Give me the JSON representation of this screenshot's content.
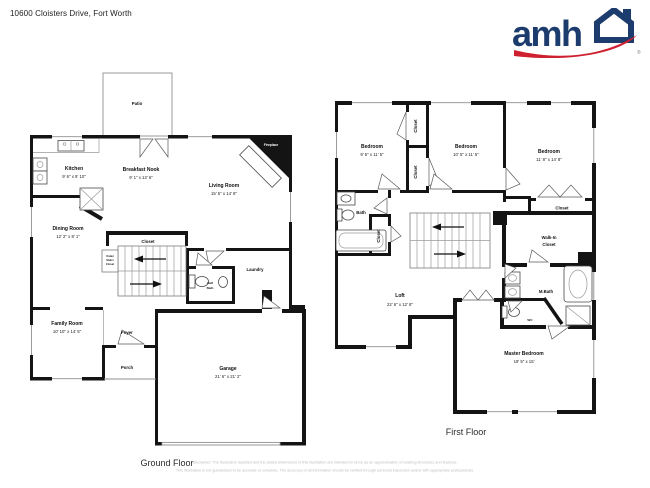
{
  "header": {
    "address": "10600 Cloisters Drive, Fort Worth"
  },
  "logo": {
    "brand": "amh",
    "registered": "®",
    "navy": "#1d3c6e",
    "red": "#cf2030"
  },
  "ground_floor": {
    "title": "Ground Floor",
    "patio": {
      "name": "Patio"
    },
    "kitchen": {
      "name": "Kitchen",
      "dims": "9' 6\" x 9' 10\""
    },
    "breakfast_nook": {
      "name": "Breakfast Nook",
      "dims": "9' 1\" x 12' 6\""
    },
    "living_room": {
      "name": "Living Room",
      "dims": "15' 5\" x 14' 8\""
    },
    "dining_room": {
      "name": "Dining Room",
      "dims": "12' 2\" x 8' 1\""
    },
    "family_room": {
      "name": "Family Room",
      "dims": "10' 10\" x 14' 5\""
    },
    "garage": {
      "name": "Garage",
      "dims": "21' 6\" x 21' 2\""
    },
    "foyer": {
      "name": "Foyer"
    },
    "porch": {
      "name": "Porch"
    },
    "laundry": {
      "name": "Laundry"
    },
    "stairs_closet": {
      "name": "Closet"
    },
    "under_stairs_closet": {
      "line1": "Under",
      "line2": "Stairs",
      "line3": "Closet"
    },
    "half_bath": {
      "line1": "Half",
      "line2": "Bath"
    },
    "fireplace": {
      "name": "Fireplace"
    }
  },
  "first_floor": {
    "title": "First Floor",
    "bedroom_1": {
      "name": "Bedroom",
      "dims": "9' 5\" x 11' 5\""
    },
    "bedroom_2": {
      "name": "Bedroom",
      "dims": "10' 5\" x 11' 5\""
    },
    "bedroom_3": {
      "name": "Bedroom",
      "dims": "11' 8\" x 14' 8\""
    },
    "closet_1": {
      "name": "Closet"
    },
    "closet_2": {
      "name": "Closet"
    },
    "bedroom_3_closet": {
      "name": "Closet"
    },
    "bath": {
      "name": "Bath"
    },
    "bath_closet": {
      "name": "Closet"
    },
    "walk_in_closet": {
      "line1": "Walk-In",
      "line2": "Closet"
    },
    "loft": {
      "name": "Loft",
      "dims": "22' 6\" x 12' 8\""
    },
    "master_bath": {
      "name": "M.Bath"
    },
    "wc": {
      "name": "WC"
    },
    "master_bedroom": {
      "name": "Master Bedroom",
      "dims": "18' 5\" x 15'"
    }
  },
  "footer": {
    "disclaimer_line1": "Disclaimer: The floorplans depicted and the stated dimensions in this illustration are intended to serve as an approximation of existing structures and features.",
    "disclaimer_line2": "This illustration is not guaranteed to be accurate or complete. The accuracy of all information should be verified through personal inspection and/or with appropriate professionals."
  }
}
